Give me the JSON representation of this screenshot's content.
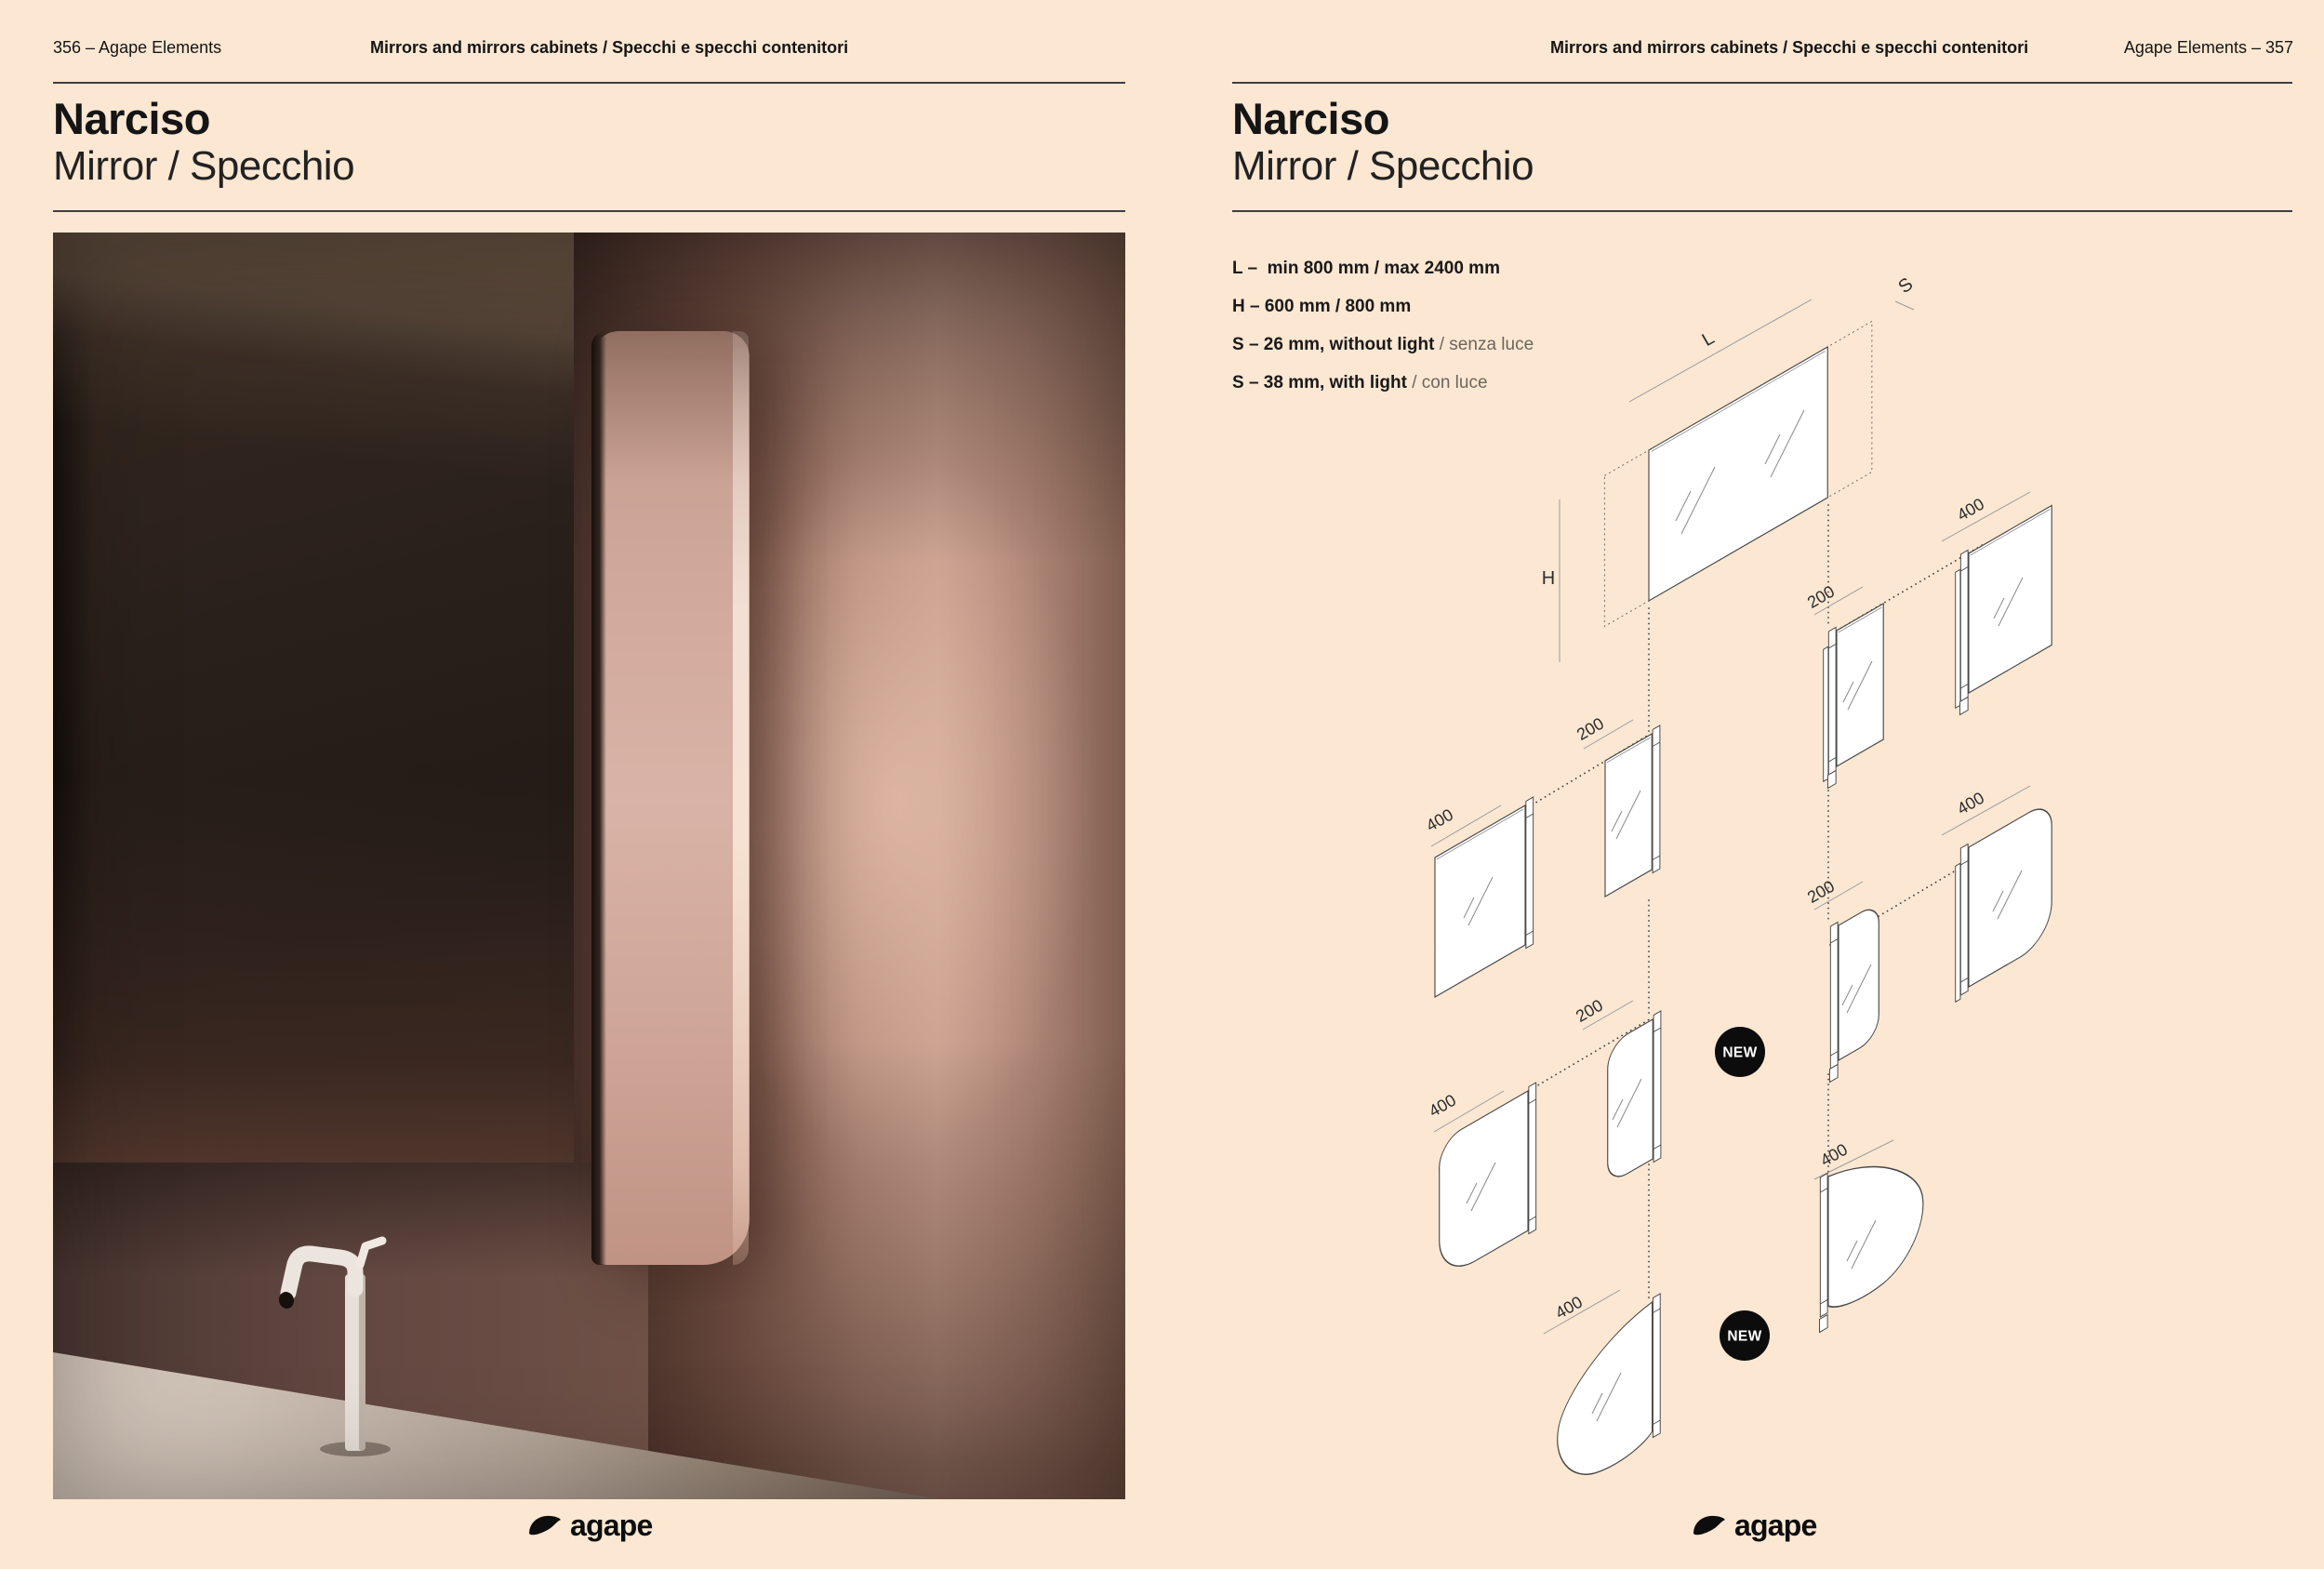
{
  "colors": {
    "page_background": "#fbe7d2",
    "ink": "#151515",
    "muted_text": "#6d665e",
    "diagram_line": "#474747",
    "badge_background": "#0c0c0c"
  },
  "left_page": {
    "header": {
      "page_label": "356 – Agape Elements",
      "section": "Mirrors and mirrors cabinets / Specchi e specchi contenitori"
    },
    "title": "Narciso",
    "subtitle": "Mirror / Specchio",
    "photo_alt": "narciso-mirror-bathroom-photo",
    "logo_text": "agape"
  },
  "right_page": {
    "header": {
      "section": "Mirrors and mirrors cabinets / Specchi e specchi contenitori",
      "page_label": "Agape Elements – 357"
    },
    "title": "Narciso",
    "subtitle": "Mirror / Specchio",
    "specs": [
      {
        "main": "L –  min 800 mm / max 2400 mm",
        "note": ""
      },
      {
        "main": "H – 600 mm / 800 mm",
        "note": ""
      },
      {
        "main": "S – 26 mm, without light",
        "note": " / senza luce"
      },
      {
        "main": "S – 38 mm, with light",
        "note": " / con luce"
      }
    ],
    "diagram": {
      "label_l": "L",
      "label_h": "H",
      "label_s": "S",
      "dim_400": "400",
      "dim_200": "200",
      "badge_new": "NEW"
    },
    "logo_text": "agape"
  }
}
